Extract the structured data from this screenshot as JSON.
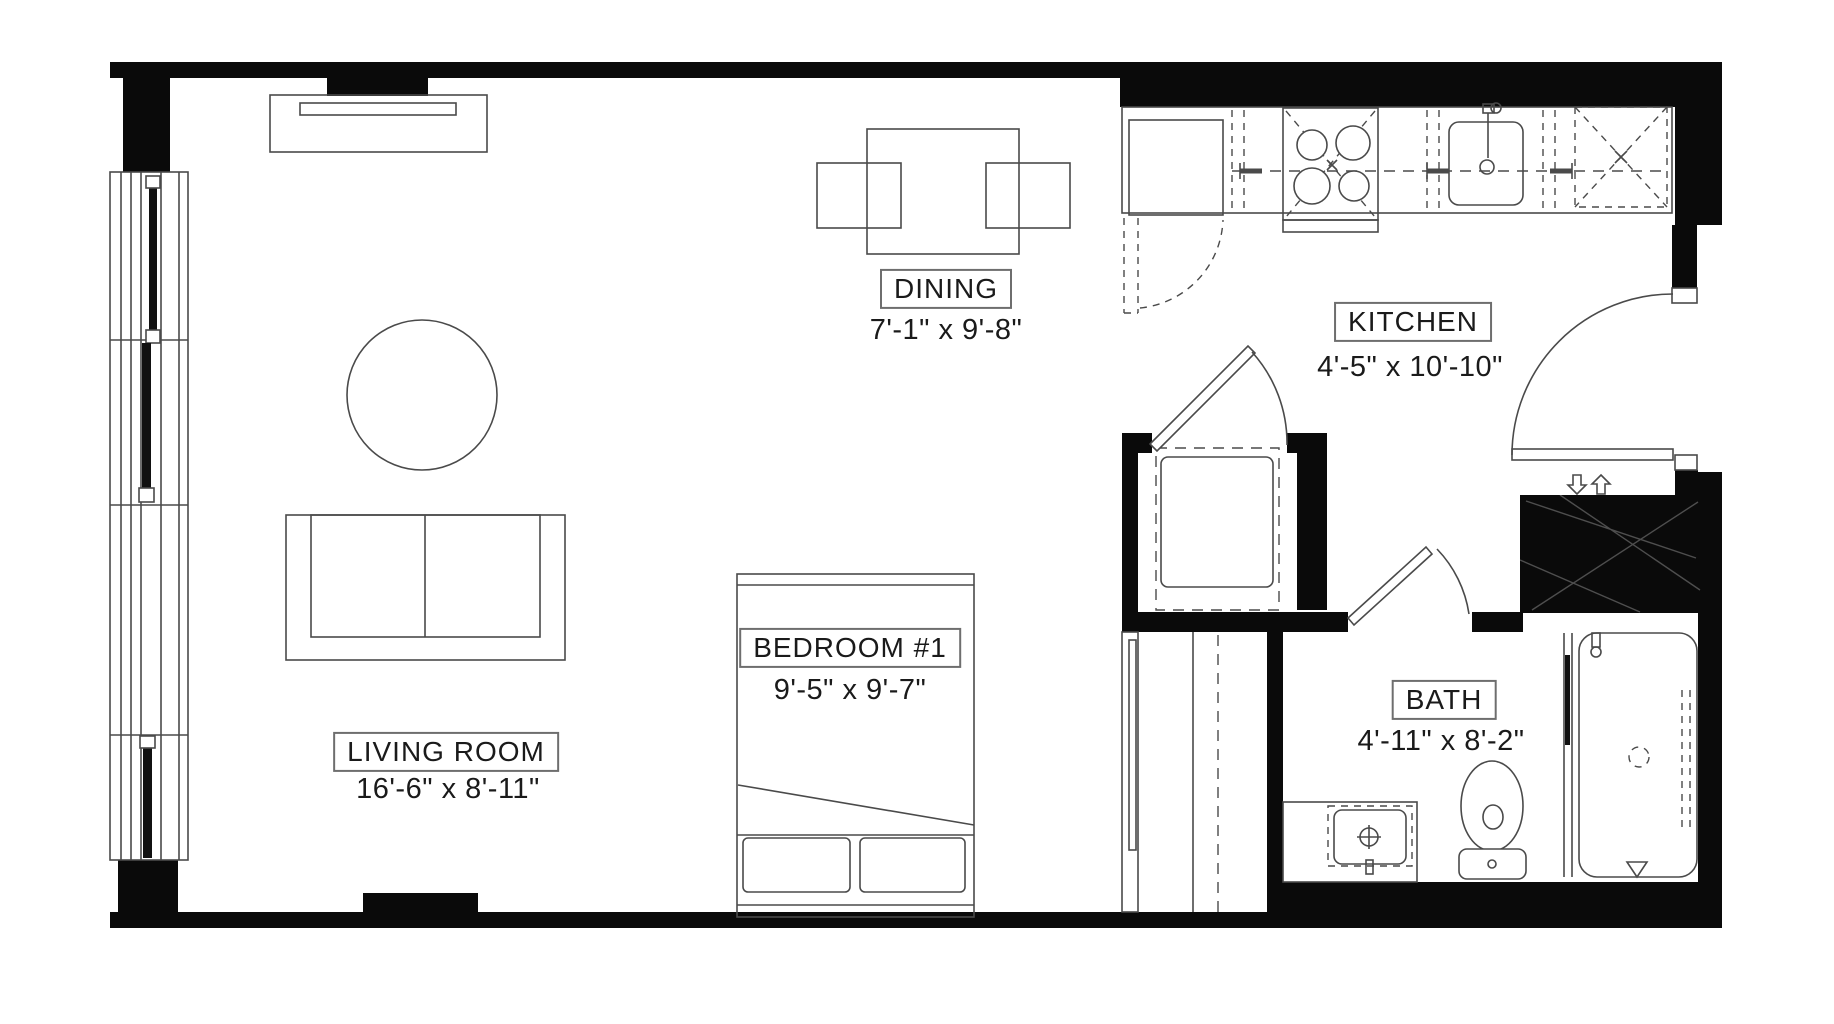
{
  "plan": {
    "title": "Studio apartment floor plan",
    "rooms": [
      {
        "id": "living",
        "name": "LIVING ROOM",
        "dims": "16'-6\" x 8'-11\""
      },
      {
        "id": "dining",
        "name": "DINING",
        "dims": "7'-1\" x 9'-8\""
      },
      {
        "id": "kitchen",
        "name": "KITCHEN",
        "dims": "4'-5\" x 10'-10\""
      },
      {
        "id": "bedroom",
        "name": "BEDROOM #1",
        "dims": "9'-5\" x 9'-7\""
      },
      {
        "id": "bath",
        "name": "BATH",
        "dims": "4'-11\" x 8'-2\""
      }
    ],
    "colors": {
      "wall": "#0a0a0a",
      "line": "#4a4a4a",
      "background": "#ffffff",
      "text": "#1a1a1a",
      "accentdark": "#111111"
    }
  }
}
